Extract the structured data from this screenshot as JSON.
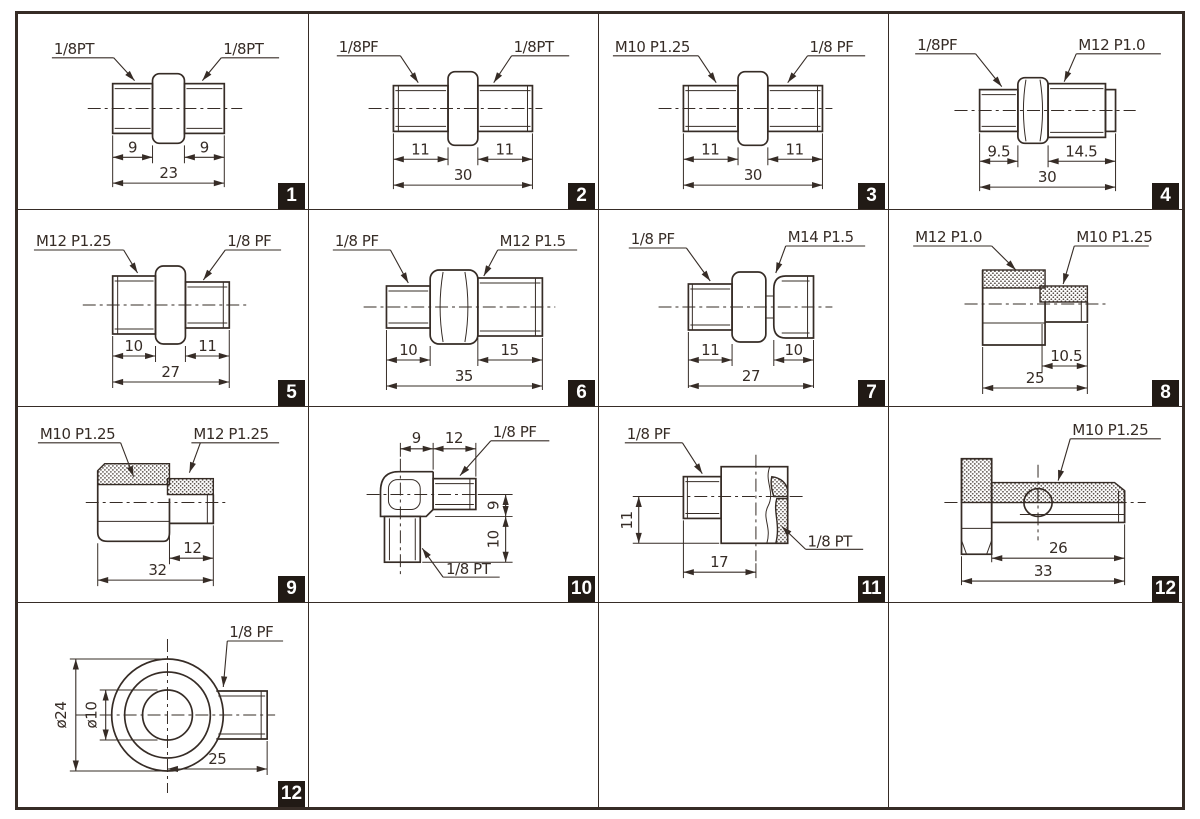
{
  "palette": {
    "line_color": "#362c26",
    "badge_bg": "#211a15",
    "badge_fg": "#ffffff",
    "background": "#ffffff"
  },
  "cells": [
    {
      "badge": "1",
      "label_left": "1/8PT",
      "label_right": "1/8PT",
      "dim_left": "9",
      "dim_right": "9",
      "dim_total": "23"
    },
    {
      "badge": "2",
      "label_left": "1/8PF",
      "label_right": "1/8PT",
      "dim_left": "11",
      "dim_right": "11",
      "dim_total": "30"
    },
    {
      "badge": "3",
      "label_left": "M10 P1.25",
      "label_right": "1/8 PF",
      "dim_left": "11",
      "dim_right": "11",
      "dim_total": "30"
    },
    {
      "badge": "4",
      "label_left": "1/8PF",
      "label_right": "M12 P1.0",
      "dim_left": "9.5",
      "dim_right": "14.5",
      "dim_total": "30"
    },
    {
      "badge": "5",
      "label_left": "M12 P1.25",
      "label_right": "1/8 PF",
      "dim_left": "10",
      "dim_right": "11",
      "dim_total": "27"
    },
    {
      "badge": "6",
      "label_left": "1/8 PF",
      "label_right": "M12 P1.5",
      "dim_left": "10",
      "dim_right": "15",
      "dim_total": "35"
    },
    {
      "badge": "7",
      "label_left": "1/8 PF",
      "label_right": "M14 P1.5",
      "dim_left": "11",
      "dim_right": "10",
      "dim_total": "27"
    },
    {
      "badge": "8",
      "label_left": "M12 P1.0",
      "label_right": "M10 P1.25",
      "dim_right": "10.5",
      "dim_total": "25"
    },
    {
      "badge": "9",
      "label_left": "M10 P1.25",
      "label_right": "M12 P1.25",
      "dim_right": "12",
      "dim_total": "32"
    },
    {
      "badge": "10",
      "label_top": "1/8 PF",
      "label_bottom": "1/8 PT",
      "dim_top1": "9",
      "dim_top2": "12",
      "dim_side1": "9",
      "dim_side2": "10"
    },
    {
      "badge": "11",
      "label_left": "1/8 PF",
      "label_right": "1/8 PT",
      "dim_height": "11",
      "dim_width": "17"
    },
    {
      "badge": "12",
      "label": "M10 P1.25",
      "dim_inner": "26",
      "dim_total": "33"
    },
    {
      "badge": "12",
      "label": "1/8 PF",
      "dim_outer_dia": "ø24",
      "dim_bore_dia": "ø10",
      "dim_length": "25"
    }
  ]
}
